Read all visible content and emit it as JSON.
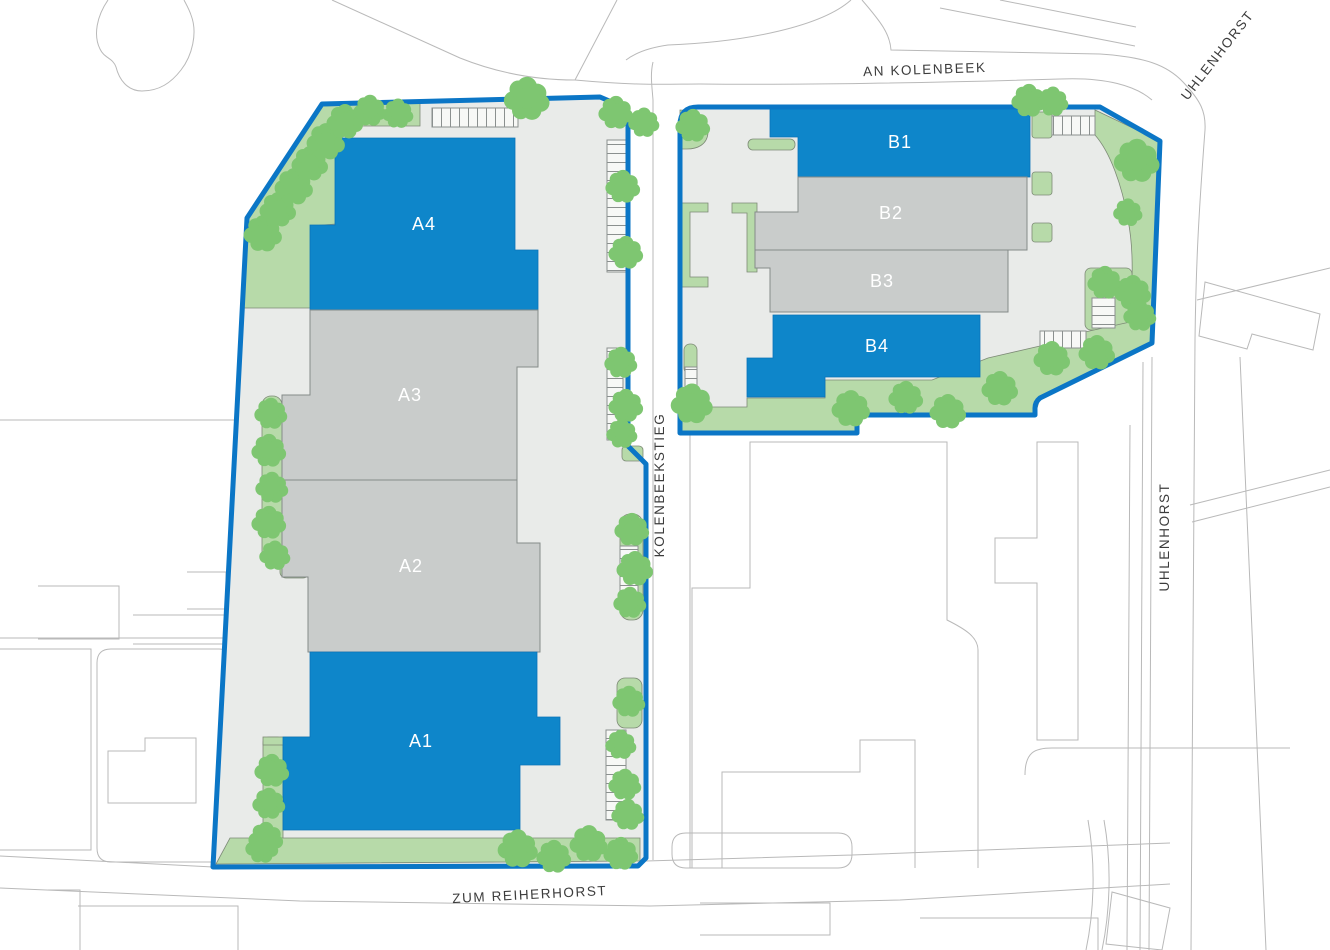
{
  "map": {
    "type": "site-plan",
    "streets": [
      {
        "id": "an-kolenbeek",
        "label": "AN KOLENBEEK"
      },
      {
        "id": "uhlenhorst-north",
        "label": "UHLENHORST"
      },
      {
        "id": "kolenbeekstieg",
        "label": "KOLENBEEKSTIEG"
      },
      {
        "id": "uhlenhorst-east",
        "label": "UHLENHORST"
      },
      {
        "id": "zum-reiherhorst",
        "label": "ZUM REIHERHORST"
      }
    ],
    "sites": [
      {
        "id": "site-a",
        "buildings": [
          {
            "id": "A1",
            "label": "A1",
            "style": "highlighted"
          },
          {
            "id": "A2",
            "label": "A2",
            "style": "standard"
          },
          {
            "id": "A3",
            "label": "A3",
            "style": "standard"
          },
          {
            "id": "A4",
            "label": "A4",
            "style": "highlighted"
          }
        ]
      },
      {
        "id": "site-b",
        "buildings": [
          {
            "id": "B1",
            "label": "B1",
            "style": "highlighted"
          },
          {
            "id": "B2",
            "label": "B2",
            "style": "standard"
          },
          {
            "id": "B3",
            "label": "B3",
            "style": "standard"
          },
          {
            "id": "B4",
            "label": "B4",
            "style": "highlighted"
          }
        ]
      }
    ],
    "colors": {
      "highlight_blue": "#0e86ca",
      "boundary_blue": "#0b76c6",
      "building_gray": "#c9cccb",
      "ground_gray": "#e9ebe9",
      "green_area": "#b7daa9",
      "tree_green": "#7ec671",
      "context_outline": "#b9b9b9",
      "street_label": "#3c3c3c",
      "building_label": "#ffffff"
    }
  }
}
